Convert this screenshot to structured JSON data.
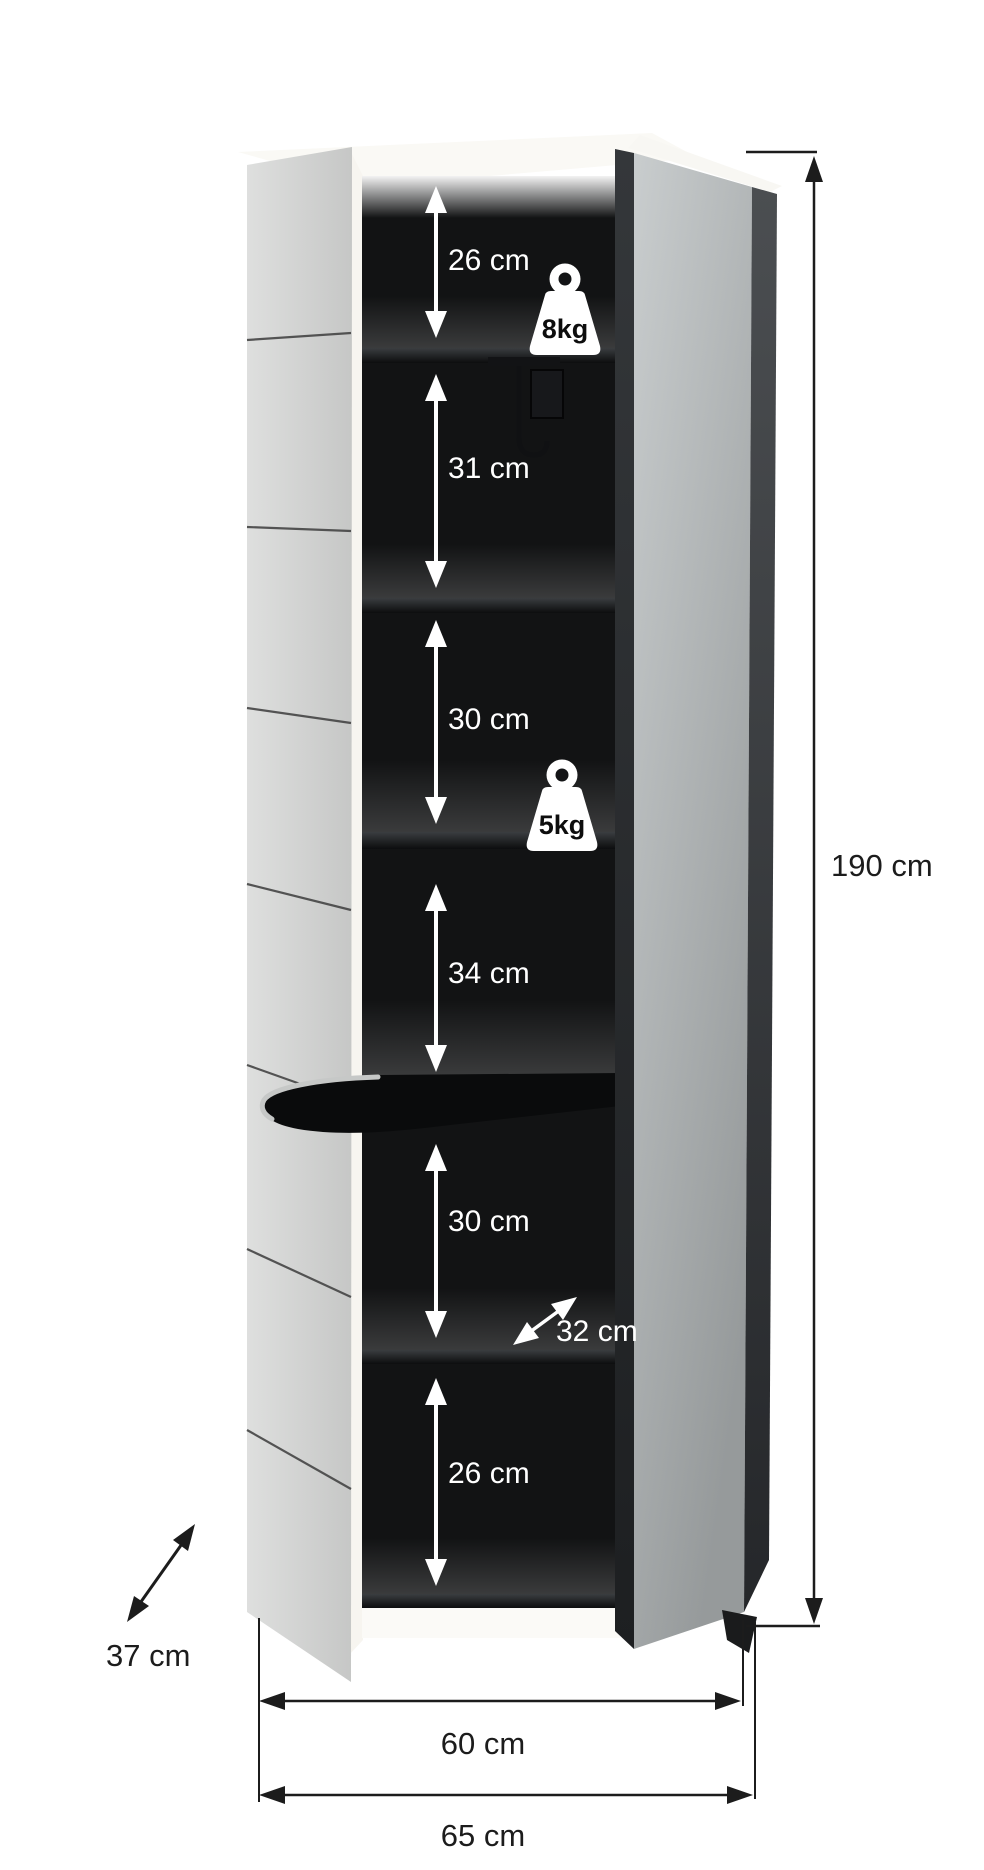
{
  "title": "Tall cabinet dimension diagram, doors open",
  "annotations": {
    "compartment_heights": [
      {
        "label": "26 cm"
      },
      {
        "label": "31 cm"
      },
      {
        "label": "30 cm"
      },
      {
        "label": "34 cm"
      },
      {
        "label": "30 cm"
      },
      {
        "label": "26 cm"
      }
    ],
    "shelf_depth": {
      "label": "32 cm"
    },
    "max_loads": [
      {
        "label": "8kg"
      },
      {
        "label": "5kg"
      }
    ],
    "total_height": {
      "label": "190 cm"
    },
    "cabinet_depth": {
      "label": "37 cm"
    },
    "body_width": {
      "label": "60 cm"
    },
    "total_width": {
      "label": "65 cm"
    }
  },
  "icons": {
    "top_load": "weight-icon",
    "mid_load": "weight-icon",
    "hanger": "coat-hook-icon"
  },
  "colors": {
    "background": "#ffffff",
    "interior_black": "#121314",
    "door_white": "#d2d3d2",
    "mirror_gray": "#aeb2b3",
    "door_edge_dark": "#35383a",
    "annotation_dark": "#1c1c1c",
    "annotation_light": "#ffffff"
  }
}
